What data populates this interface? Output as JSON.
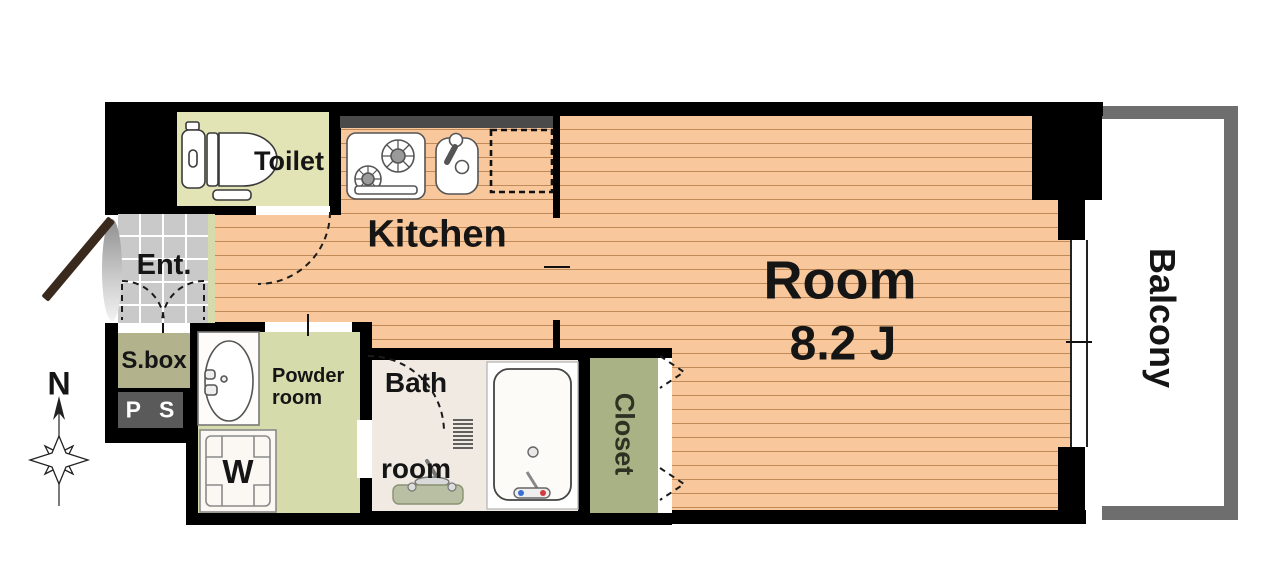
{
  "rooms": {
    "toilet": {
      "label": "Toilet"
    },
    "kitchen": {
      "label": "Kitchen"
    },
    "main_room": {
      "label": "Room",
      "size": "8.2 J"
    },
    "balcony": {
      "label": "Balcony"
    },
    "entrance": {
      "label": "Ent."
    },
    "shoe_box": {
      "label": "S.box"
    },
    "pipe_space": {
      "label": "P S"
    },
    "powder_room": {
      "line1": "Powder",
      "line2": "room"
    },
    "bath_room": {
      "line1": "Bath",
      "line2": "room"
    },
    "closet": {
      "label": "Closet"
    },
    "washing_machine": {
      "label": "W"
    }
  },
  "compass": {
    "north": "N"
  },
  "colors": {
    "wall": "#000000",
    "floor": "#f9c79c",
    "floor_line": "#c08a58",
    "toilet_bg": "#e3e4b6",
    "powder_bg": "#d6dbab",
    "step_bg": "#d6dbab",
    "sbox_bg": "#b2b28c",
    "closet_bg": "#a9b285",
    "ps_bg": "#5a5a5a",
    "tile": "#c9c9c9",
    "tile_line": "#ffffff",
    "bath_bg": "#f0eae3",
    "bath_counter": "#b9bfa2",
    "balcony_wall": "#6e6e6e",
    "counter_top": "#4a4a4a",
    "door_brown": "#3a2a1e"
  }
}
